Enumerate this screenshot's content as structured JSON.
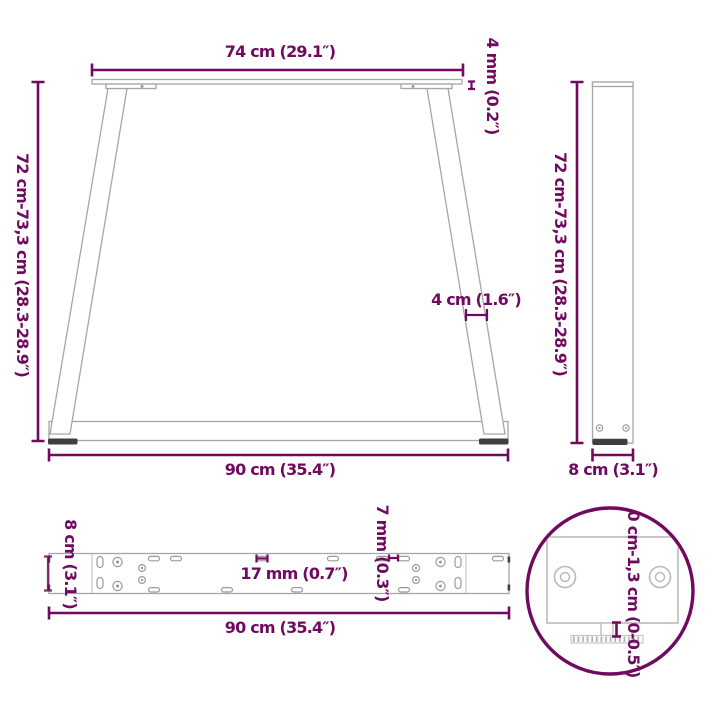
{
  "diagram": {
    "accent_color": "#700A60",
    "line_color": "#a6a6a6",
    "front": {
      "top_width": "74 cm (29.1″)",
      "plate_thickness": "4 mm (0.2″)",
      "height": "72 cm-73,3 cm (28.3-28.9″)",
      "strut_width": "4 cm (1.6″)",
      "bottom_width": "90 cm (35.4″)"
    },
    "side": {
      "height": "72 cm-73,3 cm (28.3-28.9″)",
      "width": "8 cm (3.1″)"
    },
    "plate": {
      "width": "8 cm (3.1″)",
      "slot_length": "17 mm (0.7″)",
      "hole_width": "7 mm (0.3″)",
      "length": "90 cm (35.4″)"
    },
    "foot_detail": {
      "adjustable_range": "0 cm-1,3 cm (0-0.5″)"
    }
  }
}
